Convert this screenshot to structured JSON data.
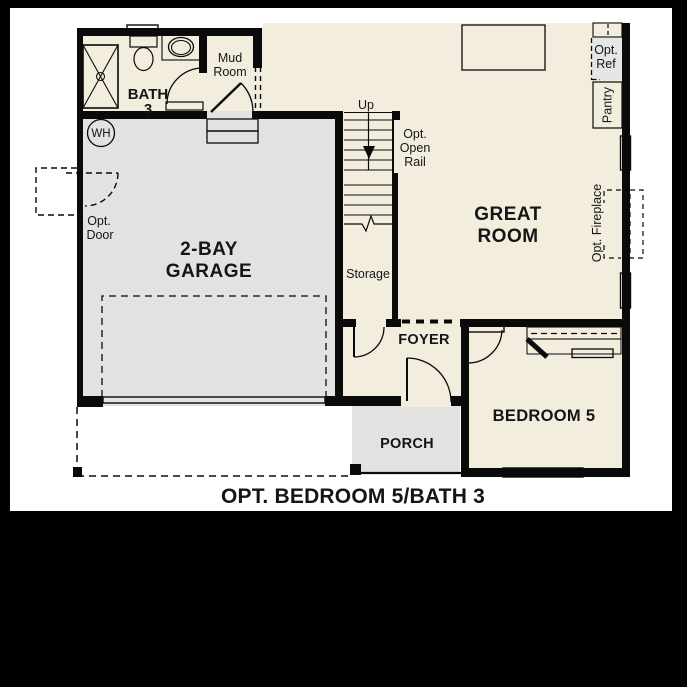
{
  "caption": "OPT. BEDROOM 5/BATH 3",
  "rooms": {
    "garage": {
      "line1": "2-BAY",
      "line2": "GARAGE"
    },
    "great_room": {
      "line1": "GREAT",
      "line2": "ROOM"
    },
    "bath3": {
      "line1": "BATH",
      "line2": "3"
    },
    "mud_room": {
      "line1": "Mud",
      "line2": "Room"
    },
    "foyer": {
      "label": "FOYER"
    },
    "bedroom5": {
      "label": "BEDROOM 5"
    },
    "porch": {
      "label": "PORCH"
    },
    "storage": {
      "label": "Storage"
    }
  },
  "annotations": {
    "water_heater": "WH",
    "stairs_up": "Up",
    "opt_open_rail": {
      "line1": "Opt.",
      "line2": "Open",
      "line3": "Rail"
    },
    "opt_door": {
      "line1": "Opt.",
      "line2": "Door"
    },
    "opt_ref": {
      "line1": "Opt.",
      "line2": "Ref"
    },
    "pantry": "Pantry",
    "opt_fireplace": "Opt. Fireplace"
  },
  "colors": {
    "floor_cream": "#f3edde",
    "garage_gray": "#e3e2e0",
    "counter_tan": "#cfc3ab",
    "fixture_blue": "#a9c9e9",
    "ref_gray": "#e6e6e6",
    "wall_black": "#0a0a0a",
    "paper_white": "#ffffff"
  }
}
